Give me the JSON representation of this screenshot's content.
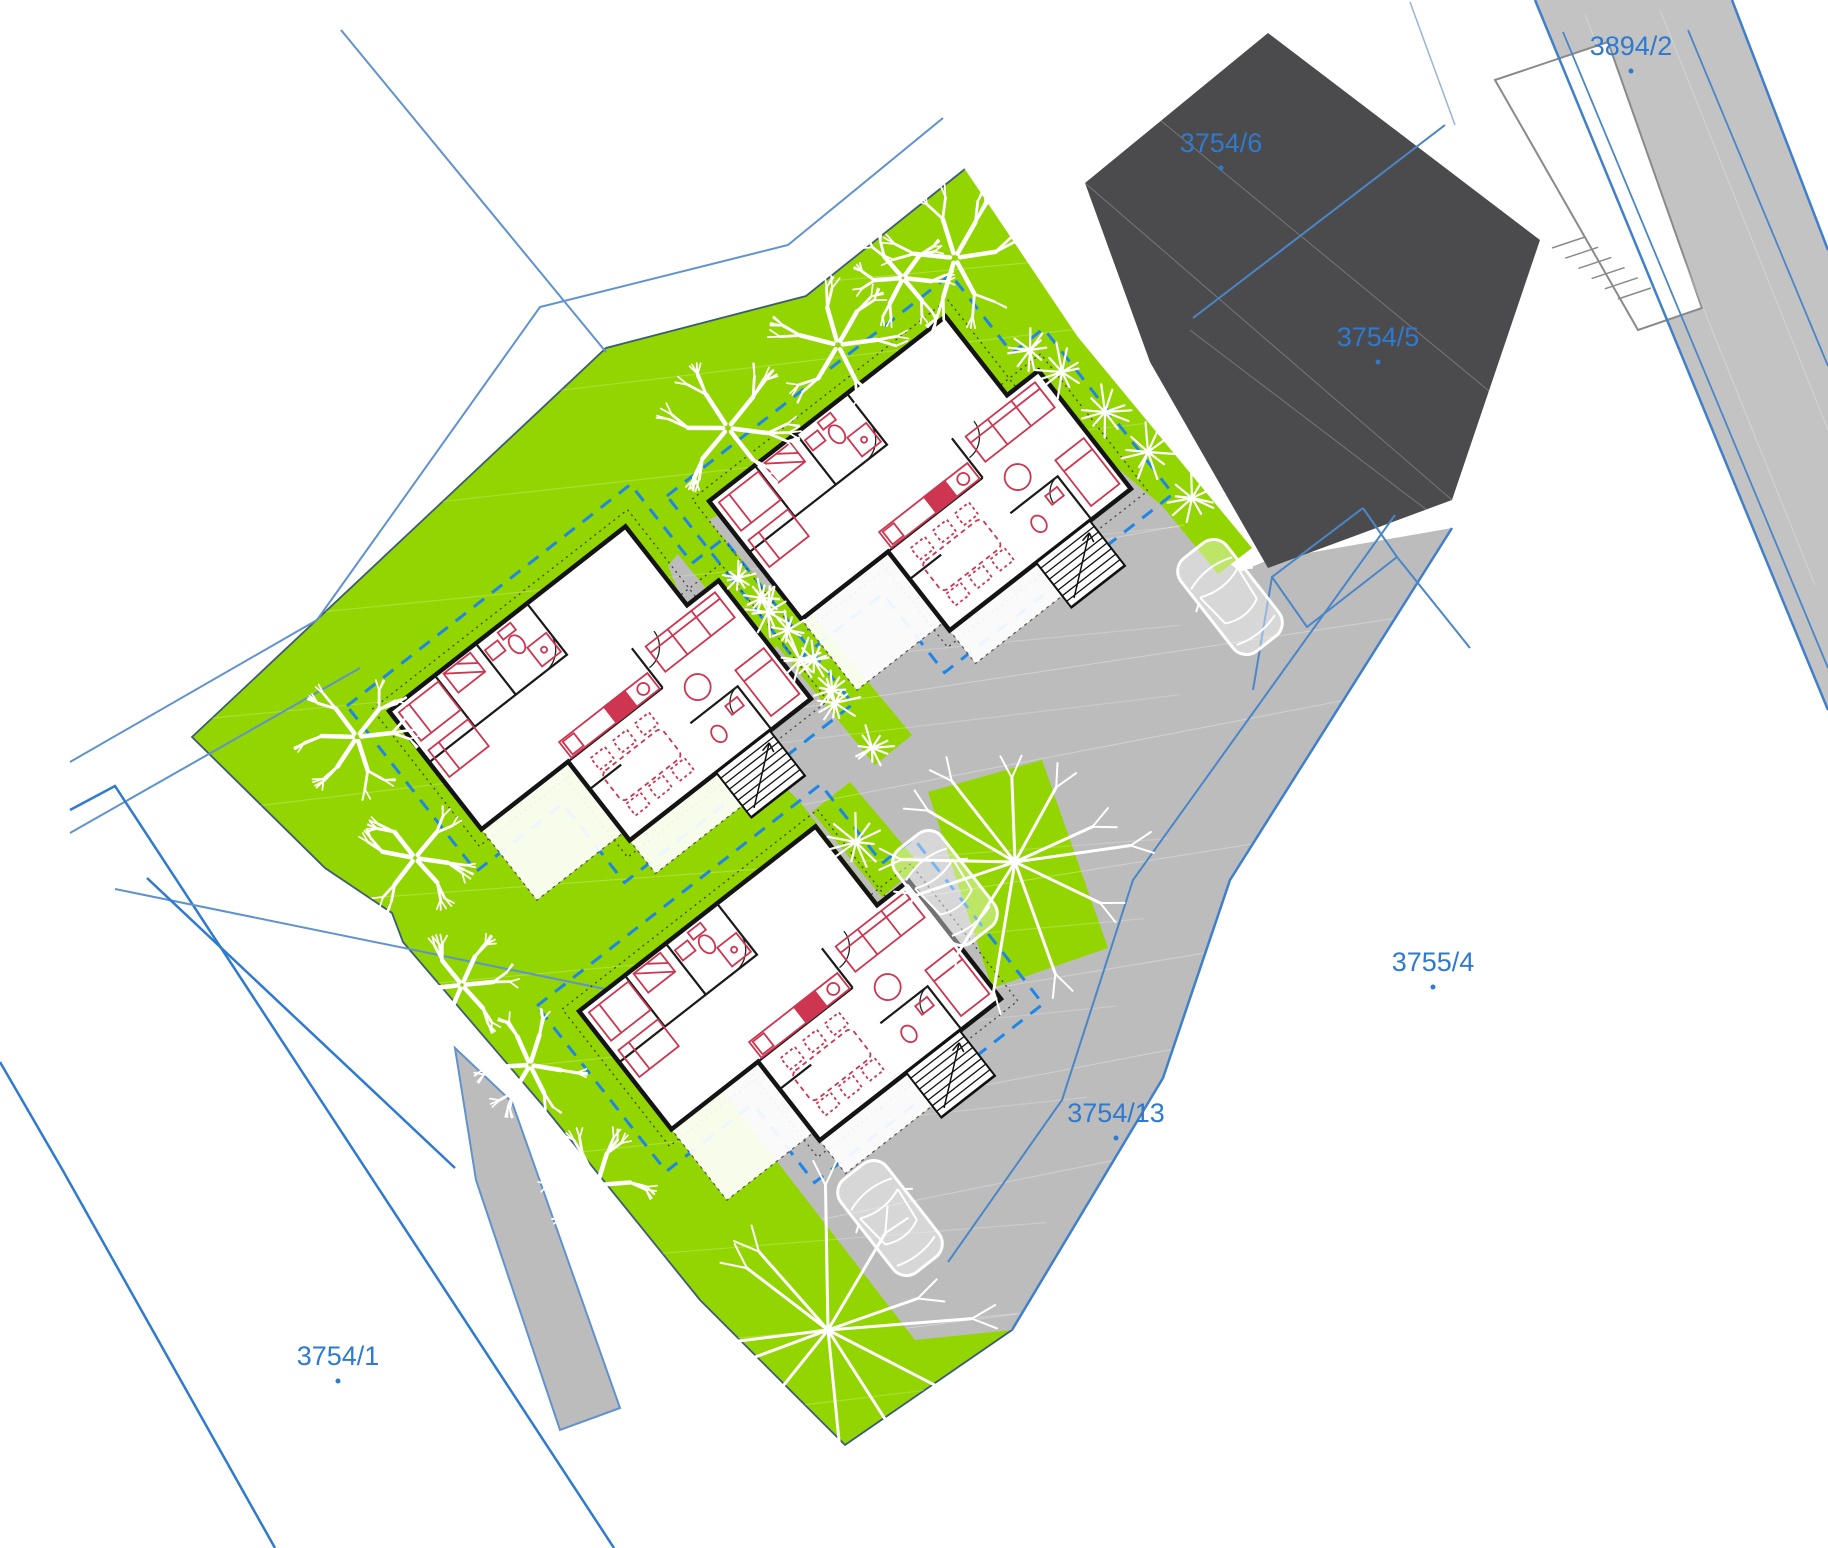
{
  "drawing": {
    "kind": "architectural site plan",
    "canvas": {
      "width": 1828,
      "height": 1548
    }
  },
  "colors": {
    "lawn_green": "#93d500",
    "paving_gray": "#bcbcbc",
    "road_gray": "#c3c3c3",
    "existing_building_dark": "#4b4b4d",
    "parcel_label_blue": "#2e7ad1",
    "cadastre_line_blue": "#3f7fcb",
    "setback_dash_blue": "#1d86e8",
    "wall_black": "#141414",
    "furniture_red": "#cd3550",
    "tree_white": "#ffffff"
  },
  "parcels": [
    {
      "id": "3894/2",
      "x": 1631,
      "y": 55
    },
    {
      "id": "3754/6",
      "x": 1221,
      "y": 152
    },
    {
      "id": "3754/5",
      "x": 1378,
      "y": 346
    },
    {
      "id": "3755/4",
      "x": 1433,
      "y": 971
    },
    {
      "id": "3754/13",
      "x": 1116,
      "y": 1122
    },
    {
      "id": "3754/1",
      "x": 338,
      "y": 1365
    }
  ],
  "houses": [
    {
      "name": "house-a",
      "x": 920,
      "y": 495,
      "rotation": -38
    },
    {
      "name": "house-b",
      "x": 600,
      "y": 705,
      "rotation": -38
    },
    {
      "name": "house-c",
      "x": 790,
      "y": 1005,
      "rotation": -38
    }
  ],
  "cars": [
    {
      "name": "car-1",
      "x": 1230,
      "y": 597,
      "rotation": -38
    },
    {
      "name": "car-2",
      "x": 945,
      "y": 888,
      "rotation": -38
    },
    {
      "name": "car-3",
      "x": 890,
      "y": 1218,
      "rotation": -38
    }
  ],
  "trees": {
    "round": [
      [
        955,
        258,
        72
      ],
      [
        903,
        278,
        50
      ],
      [
        838,
        345,
        68
      ],
      [
        728,
        428,
        70
      ],
      [
        357,
        737,
        62
      ],
      [
        415,
        858,
        58
      ],
      [
        462,
        985,
        55
      ],
      [
        530,
        1065,
        55
      ],
      [
        597,
        1185,
        58
      ]
    ],
    "sparse": [
      [
        1015,
        862,
        135
      ],
      [
        828,
        1330,
        150
      ]
    ],
    "tufts": [
      [
        1062,
        372,
        30
      ],
      [
        1105,
        412,
        28
      ],
      [
        1148,
        452,
        30
      ],
      [
        1192,
        498,
        26
      ],
      [
        1030,
        350,
        22
      ],
      [
        768,
        612,
        26
      ],
      [
        800,
        660,
        24
      ],
      [
        835,
        703,
        26
      ],
      [
        872,
        748,
        24
      ],
      [
        762,
        598,
        20
      ],
      [
        788,
        630,
        20
      ],
      [
        814,
        660,
        20
      ],
      [
        832,
        690,
        20
      ],
      [
        856,
        842,
        30
      ],
      [
        738,
        578,
        18
      ]
    ]
  }
}
